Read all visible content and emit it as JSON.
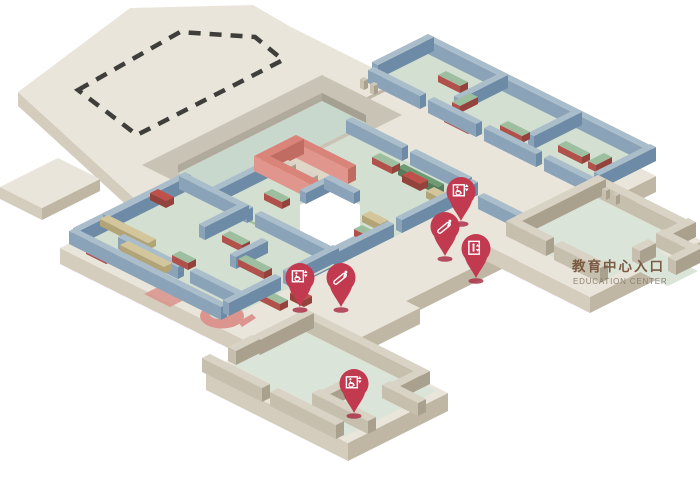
{
  "map": {
    "label": {
      "zh": "教育中心入口",
      "en": "EDUCATION CENTER"
    },
    "pins": [
      {
        "id": "accessible-elevator-1",
        "icon": "accessible-elevator",
        "x": 461,
        "y": 221
      },
      {
        "id": "escalator-1",
        "icon": "escalator",
        "x": 445,
        "y": 256
      },
      {
        "id": "elevator-1",
        "icon": "elevator",
        "x": 476,
        "y": 278
      },
      {
        "id": "accessible-elevator-2",
        "icon": "accessible-elevator",
        "x": 300,
        "y": 307
      },
      {
        "id": "escalator-2",
        "icon": "escalator",
        "x": 341,
        "y": 307
      },
      {
        "id": "accessible-elevator-3",
        "icon": "accessible-elevator",
        "x": 354,
        "y": 413
      }
    ],
    "palette": {
      "background": "#ffffff",
      "plate_top": "#e9e5da",
      "plate_side_light": "#d4cdbd",
      "plate_side_dark": "#bfb7a4",
      "band_gray": "#c9c3b5",
      "band_inner_light": "#b0aa9c",
      "band_inner_dark": "#a5a092",
      "floor_green": "#d2dfd1",
      "courtyard_green": "#c9d8cc",
      "floor_pale": "#dae4d8",
      "wall_blue_top": "#aabdca",
      "wall_blue_light": "#8aa3b8",
      "wall_blue_dark": "#6d8ba6",
      "concrete_top": "#d9d3c5",
      "concrete_light": "#c6bfae",
      "concrete_dark": "#a9a18e",
      "red_wall_top": "#d98379",
      "red_wall_light": "#e0968c",
      "red_wall_dark": "#c16c62",
      "pavilion_floor": "#ded7c7",
      "table_green": "#9dbfa0",
      "table_red_light": "#b0524b",
      "table_red_dark": "#93423c",
      "table_red_top": "#c0504a",
      "table_tan": "#d3c69c",
      "table_tan_dark": "#b3a478",
      "counter_green": "#6f9b74",
      "counter_green_dark": "#567c5b",
      "bench_top": "#d8d3c6",
      "bench_light": "#bcb6a6",
      "bench_dark": "#a49d8b",
      "spiral_red": "#db948e",
      "rug_red": "#d8938c",
      "post_gray": "#cfc9bb",
      "pin_red": "#c13a50",
      "pin_shadow": "#a93349",
      "pin_icon": "#ffffff",
      "dash_color": "#3f3e3a",
      "void_white": "#ffffff",
      "text_brown": "#7a5a42",
      "text_gray": "#8e8172"
    }
  }
}
